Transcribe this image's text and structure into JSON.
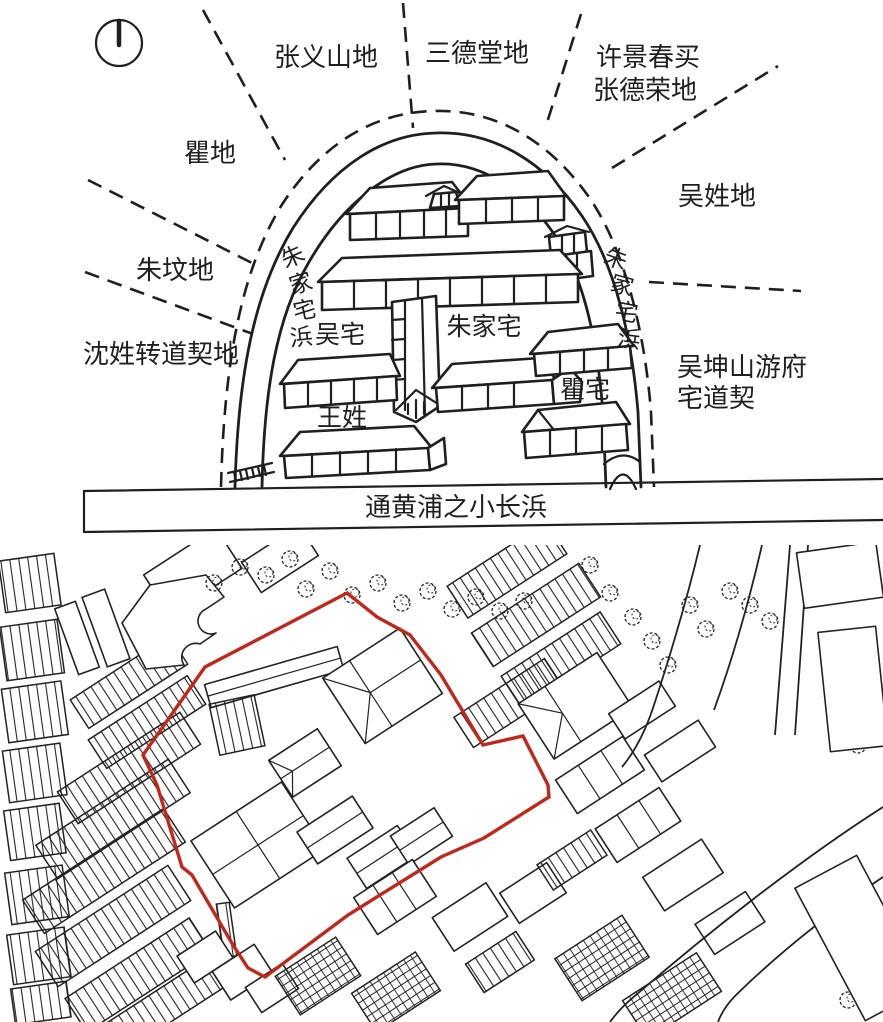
{
  "top_panel": {
    "compass_icon": "north-compass",
    "outer_labels": {
      "top_left": "张义山地",
      "top_center": "三德堂地",
      "top_right_line1": "许景春买",
      "top_right_line2": "张德荣地",
      "left_upper": "瞿地",
      "left_middle": "朱坟地",
      "left_lower": "沈姓转道契地",
      "right_upper": "吴姓地",
      "right_lower_line1": "吴坤山游府",
      "right_lower_line2": "宅道契"
    },
    "creek_left_chars": [
      "朱",
      "家",
      "宅",
      "浜"
    ],
    "creek_right_chars": [
      "朱",
      "家",
      "宅",
      "浜"
    ],
    "inner_labels": {
      "wu_house": "吴宅",
      "zhu_house": "朱家宅",
      "qu_house": "瞿宅",
      "wang_family": "王姓"
    },
    "river_label": "通黄浦之小长浜"
  },
  "bottom_panel": {
    "red_outline_color": "#c1271b",
    "red_outline_points": "347,48 377,72 410,90 441,130 483,200 523,191 548,240 549,252 484,293 441,312 348,370 265,432 248,423 233,400 192,330 182,322 157,240 143,210 205,122"
  },
  "ink_color": "#1f1f1f"
}
